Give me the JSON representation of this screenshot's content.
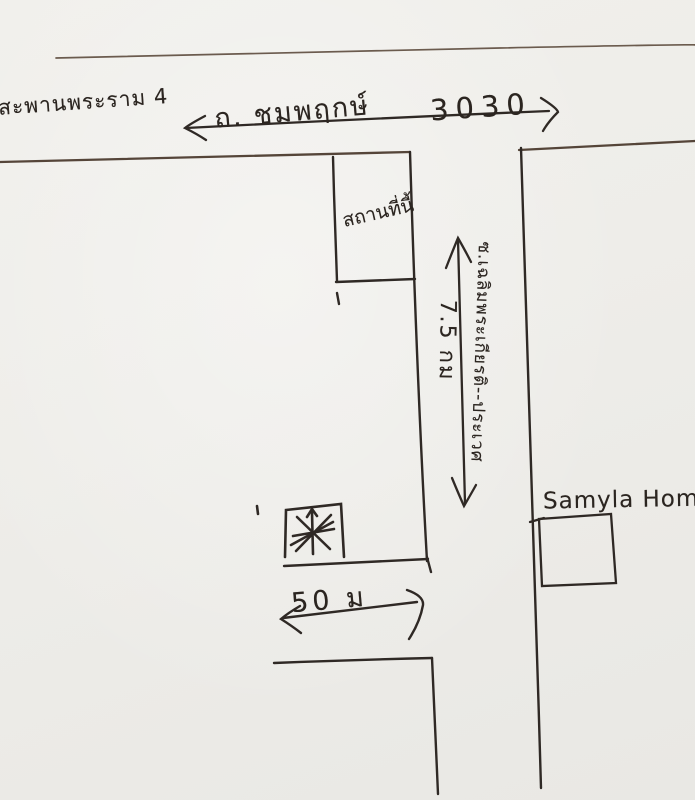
{
  "canvas": {
    "width": 695,
    "height": 800,
    "paper_color": "#eeede9",
    "ink_color": "#2b2520",
    "faint_ink_color": "#6b5b4e"
  },
  "labels": {
    "bridge": "สะพานพระราม 4",
    "main_road_name": "ถ. ชมพฤกษ์",
    "main_road_number": "3030",
    "plot_box": "สถานที่นี้",
    "soi_name_rotated": "ซ.เฉลิมพระเกียรติ--ประเวศ",
    "distance_km": "7.5 กม",
    "landmark": "Samyla Home",
    "distance_m": "50 ม"
  },
  "symbols": {
    "star_marker": "asterisk-star",
    "horizontal_dimension_arrow": "double-headed",
    "vertical_dimension_arrow": "double-headed",
    "width_dimension_arrow": "double-headed"
  }
}
